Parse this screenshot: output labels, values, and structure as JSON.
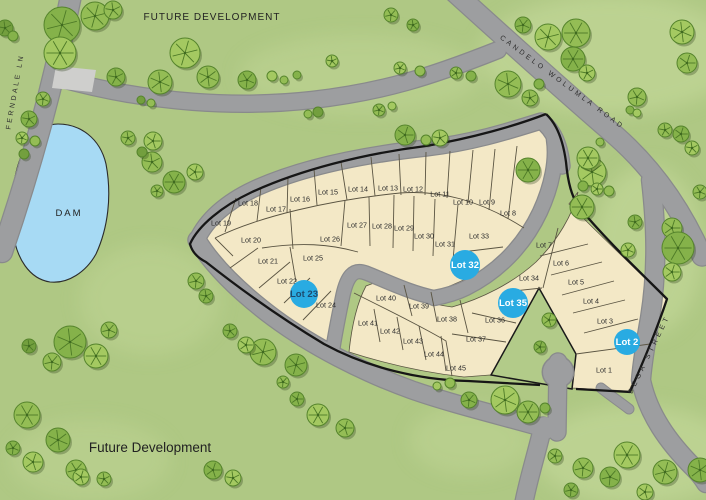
{
  "map": {
    "region_labels": {
      "future_dev_top": "FUTURE DEVELOPMENT",
      "future_dev_bottom": "Future Development",
      "dam": "DAM"
    },
    "roads": [
      {
        "id": "ferndale-ln",
        "label": "FERNDALE LN"
      },
      {
        "id": "candelo-wolumla-road",
        "label": "CANDELO WOLUMLA ROAD"
      },
      {
        "id": "bega-street",
        "label": "BEGA STREET"
      }
    ],
    "colors": {
      "grass": "#afc884",
      "grass_light": "#c6da9c",
      "road": "#9d9ea0",
      "road_edge": "#898a8c",
      "water": "#a7daf4",
      "parcel": "#f3e8c6",
      "lot_line": "#5a5442",
      "boundary": "#161616",
      "badge": "#29abe2"
    },
    "lots": [
      {
        "label": "Lot 1",
        "x": 604,
        "y": 370,
        "highlighted": false
      },
      {
        "label": "Lot 2",
        "x": 627,
        "y": 342,
        "highlighted": true,
        "r": 13,
        "text_color": "#ffffff"
      },
      {
        "label": "Lot 3",
        "x": 605,
        "y": 321,
        "highlighted": false
      },
      {
        "label": "Lot 4",
        "x": 591,
        "y": 301,
        "highlighted": false
      },
      {
        "label": "Lot 5",
        "x": 576,
        "y": 282,
        "highlighted": false
      },
      {
        "label": "Lot 6",
        "x": 561,
        "y": 263,
        "highlighted": false
      },
      {
        "label": "Lot 7",
        "x": 544,
        "y": 245,
        "highlighted": false
      },
      {
        "label": "Lot 8",
        "x": 508,
        "y": 213,
        "highlighted": false
      },
      {
        "label": "Lot 9",
        "x": 487,
        "y": 202,
        "highlighted": false
      },
      {
        "label": "Lot 10",
        "x": 463,
        "y": 202,
        "highlighted": false
      },
      {
        "label": "Lot 11",
        "x": 440,
        "y": 194,
        "highlighted": false
      },
      {
        "label": "Lot 12",
        "x": 413,
        "y": 189,
        "highlighted": false
      },
      {
        "label": "Lot 13",
        "x": 388,
        "y": 188,
        "highlighted": false
      },
      {
        "label": "Lot 14",
        "x": 358,
        "y": 189,
        "highlighted": false
      },
      {
        "label": "Lot 15",
        "x": 328,
        "y": 192,
        "highlighted": false
      },
      {
        "label": "Lot 16",
        "x": 300,
        "y": 199,
        "highlighted": false
      },
      {
        "label": "Lot 17",
        "x": 276,
        "y": 209,
        "highlighted": false
      },
      {
        "label": "Lot 18",
        "x": 248,
        "y": 203,
        "highlighted": false
      },
      {
        "label": "Lot 19",
        "x": 221,
        "y": 223,
        "highlighted": false
      },
      {
        "label": "Lot 20",
        "x": 251,
        "y": 240,
        "highlighted": false
      },
      {
        "label": "Lot 21",
        "x": 268,
        "y": 261,
        "highlighted": false
      },
      {
        "label": "Lot 22",
        "x": 287,
        "y": 281,
        "highlighted": false
      },
      {
        "label": "Lot 23",
        "x": 304,
        "y": 294,
        "highlighted": true,
        "r": 14,
        "text_color": "#1d4a6e"
      },
      {
        "label": "Lot 24",
        "x": 326,
        "y": 305,
        "highlighted": false
      },
      {
        "label": "Lot 25",
        "x": 313,
        "y": 258,
        "highlighted": false
      },
      {
        "label": "Lot 26",
        "x": 330,
        "y": 239,
        "highlighted": false
      },
      {
        "label": "Lot 27",
        "x": 357,
        "y": 225,
        "highlighted": false
      },
      {
        "label": "Lot 28",
        "x": 382,
        "y": 226,
        "highlighted": false
      },
      {
        "label": "Lot 29",
        "x": 404,
        "y": 228,
        "highlighted": false
      },
      {
        "label": "Lot 30",
        "x": 424,
        "y": 236,
        "highlighted": false
      },
      {
        "label": "Lot 31",
        "x": 445,
        "y": 244,
        "highlighted": false
      },
      {
        "label": "Lot 32",
        "x": 465,
        "y": 265,
        "highlighted": true,
        "r": 15,
        "text_color": "#ffffff"
      },
      {
        "label": "Lot 33",
        "x": 479,
        "y": 236,
        "highlighted": false
      },
      {
        "label": "Lot 34",
        "x": 529,
        "y": 278,
        "highlighted": false
      },
      {
        "label": "Lot 35",
        "x": 513,
        "y": 303,
        "highlighted": true,
        "r": 15,
        "text_color": "#ffffff"
      },
      {
        "label": "Lot 36",
        "x": 495,
        "y": 320,
        "highlighted": false
      },
      {
        "label": "Lot 37",
        "x": 476,
        "y": 339,
        "highlighted": false
      },
      {
        "label": "Lot 38",
        "x": 447,
        "y": 319,
        "highlighted": false
      },
      {
        "label": "Lot 39",
        "x": 419,
        "y": 306,
        "highlighted": false
      },
      {
        "label": "Lot 40",
        "x": 386,
        "y": 298,
        "highlighted": false
      },
      {
        "label": "Lot 41",
        "x": 368,
        "y": 323,
        "highlighted": false
      },
      {
        "label": "Lot 42",
        "x": 390,
        "y": 331,
        "highlighted": false
      },
      {
        "label": "Lot 43",
        "x": 413,
        "y": 341,
        "highlighted": false
      },
      {
        "label": "Lot 44",
        "x": 434,
        "y": 354,
        "highlighted": false
      },
      {
        "label": "Lot 45",
        "x": 456,
        "y": 368,
        "highlighted": false
      }
    ],
    "trees": [
      [
        62,
        25,
        18,
        0
      ],
      [
        95,
        16,
        14,
        1
      ],
      [
        60,
        53,
        16,
        2
      ],
      [
        113,
        10,
        9,
        1
      ],
      [
        5,
        28,
        8,
        3
      ],
      [
        13,
        36,
        5,
        0
      ],
      [
        43,
        99,
        7,
        1
      ],
      [
        29,
        119,
        8,
        0
      ],
      [
        22,
        138,
        6,
        2
      ],
      [
        35,
        141,
        5,
        1
      ],
      [
        24,
        154,
        5,
        3
      ],
      [
        128,
        138,
        7,
        1
      ],
      [
        153,
        141,
        9,
        2
      ],
      [
        185,
        53,
        15,
        2
      ],
      [
        160,
        82,
        12,
        1
      ],
      [
        116,
        77,
        9,
        0
      ],
      [
        141,
        100,
        4,
        3
      ],
      [
        151,
        103,
        4,
        1
      ],
      [
        208,
        77,
        11,
        1
      ],
      [
        247,
        80,
        9,
        0
      ],
      [
        272,
        76,
        5,
        2
      ],
      [
        284,
        80,
        4,
        1
      ],
      [
        297,
        75,
        4,
        0
      ],
      [
        318,
        112,
        5,
        3
      ],
      [
        308,
        114,
        4,
        1
      ],
      [
        332,
        61,
        6,
        2
      ],
      [
        391,
        15,
        7,
        1
      ],
      [
        413,
        25,
        6,
        0
      ],
      [
        379,
        110,
        6,
        1
      ],
      [
        392,
        106,
        4,
        2
      ],
      [
        405,
        135,
        10,
        0
      ],
      [
        440,
        138,
        8,
        2
      ],
      [
        426,
        140,
        5,
        1
      ],
      [
        456,
        73,
        6,
        1
      ],
      [
        471,
        76,
        5,
        0
      ],
      [
        400,
        68,
        6,
        2
      ],
      [
        420,
        71,
        5,
        1
      ],
      [
        508,
        84,
        13,
        1
      ],
      [
        539,
        84,
        5,
        0
      ],
      [
        548,
        37,
        13,
        2
      ],
      [
        576,
        33,
        14,
        1
      ],
      [
        573,
        59,
        12,
        0
      ],
      [
        587,
        73,
        8,
        2
      ],
      [
        523,
        25,
        8,
        0
      ],
      [
        637,
        97,
        9,
        1
      ],
      [
        682,
        32,
        12,
        2
      ],
      [
        687,
        63,
        10,
        1
      ],
      [
        630,
        110,
        4,
        0
      ],
      [
        637,
        113,
        4,
        2
      ],
      [
        665,
        130,
        7,
        1
      ],
      [
        681,
        134,
        8,
        0
      ],
      [
        692,
        148,
        7,
        2
      ],
      [
        700,
        192,
        7,
        1
      ],
      [
        152,
        162,
        10,
        1
      ],
      [
        174,
        182,
        11,
        0
      ],
      [
        195,
        172,
        8,
        2
      ],
      [
        157,
        191,
        6,
        1
      ],
      [
        142,
        152,
        5,
        3
      ],
      [
        196,
        281,
        8,
        1
      ],
      [
        206,
        296,
        7,
        0
      ],
      [
        592,
        172,
        14,
        2
      ],
      [
        582,
        207,
        12,
        1
      ],
      [
        635,
        222,
        7,
        0
      ],
      [
        628,
        250,
        7,
        2
      ],
      [
        672,
        228,
        10,
        1
      ],
      [
        678,
        248,
        16,
        0
      ],
      [
        672,
        272,
        9,
        2
      ],
      [
        530,
        98,
        8,
        1
      ],
      [
        528,
        170,
        12,
        0
      ],
      [
        588,
        158,
        11,
        2
      ],
      [
        600,
        142,
        4,
        1
      ],
      [
        583,
        186,
        5,
        0
      ],
      [
        597,
        189,
        6,
        2
      ],
      [
        609,
        191,
        5,
        1
      ],
      [
        549,
        320,
        7,
        1
      ],
      [
        540,
        347,
        6,
        0
      ],
      [
        505,
        400,
        14,
        2
      ],
      [
        528,
        412,
        11,
        1
      ],
      [
        469,
        400,
        8,
        0
      ],
      [
        450,
        383,
        5,
        1
      ],
      [
        437,
        386,
        4,
        2
      ],
      [
        545,
        408,
        5,
        0
      ],
      [
        555,
        456,
        7,
        1
      ],
      [
        571,
        490,
        7,
        0
      ],
      [
        583,
        468,
        10,
        1
      ],
      [
        610,
        477,
        10,
        0
      ],
      [
        627,
        455,
        13,
        2
      ],
      [
        665,
        472,
        12,
        1
      ],
      [
        700,
        470,
        12,
        0
      ],
      [
        645,
        492,
        8,
        2
      ],
      [
        70,
        342,
        16,
        0
      ],
      [
        96,
        356,
        12,
        2
      ],
      [
        109,
        330,
        8,
        1
      ],
      [
        52,
        362,
        9,
        1
      ],
      [
        29,
        346,
        7,
        3
      ],
      [
        27,
        415,
        13,
        1
      ],
      [
        58,
        440,
        12,
        0
      ],
      [
        33,
        462,
        10,
        2
      ],
      [
        76,
        470,
        10,
        1
      ],
      [
        13,
        448,
        7,
        0
      ],
      [
        81,
        477,
        8,
        2
      ],
      [
        104,
        479,
        7,
        1
      ],
      [
        213,
        470,
        9,
        0
      ],
      [
        233,
        478,
        8,
        2
      ],
      [
        263,
        352,
        13,
        1
      ],
      [
        296,
        365,
        11,
        0
      ],
      [
        246,
        345,
        8,
        2
      ],
      [
        283,
        382,
        6,
        1
      ],
      [
        230,
        331,
        7,
        0
      ],
      [
        318,
        415,
        11,
        2
      ],
      [
        345,
        428,
        9,
        1
      ],
      [
        297,
        399,
        7,
        0
      ]
    ],
    "tree_shades": [
      "#85b24a",
      "#94bd55",
      "#a4c961",
      "#739f3e"
    ]
  }
}
